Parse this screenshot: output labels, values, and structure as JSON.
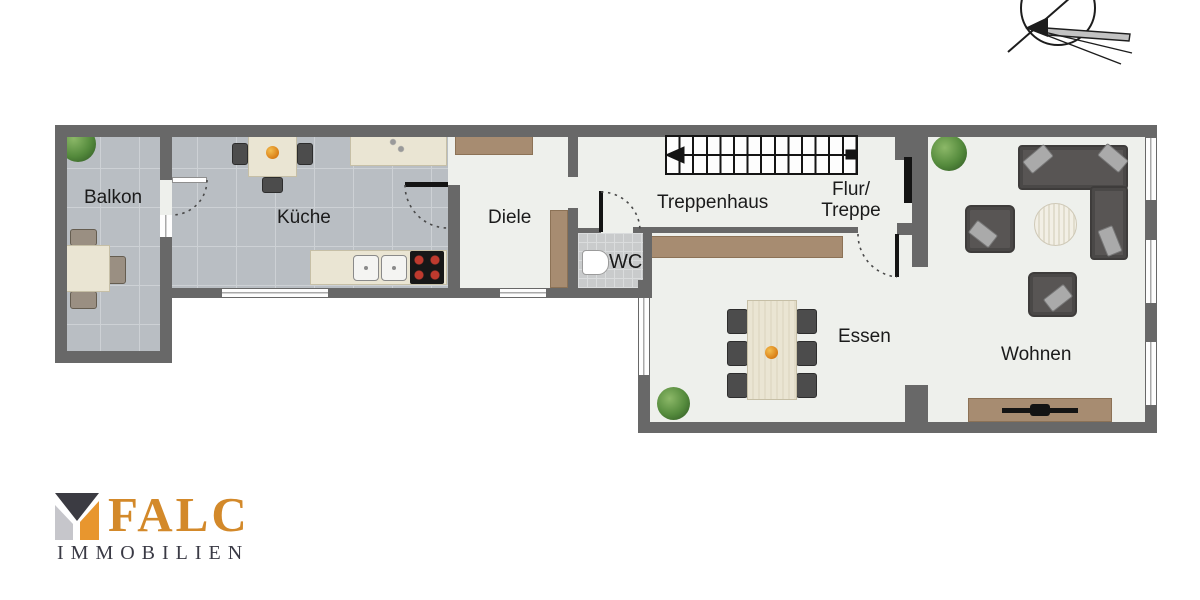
{
  "rooms": {
    "balkon": "Balkon",
    "kueche": "Küche",
    "diele": "Diele",
    "wc": "WC",
    "treppenhaus": "Treppenhaus",
    "flur1": "Flur/",
    "flur2": "Treppe",
    "essen": "Essen",
    "wohnen": "Wohnen"
  },
  "branding": {
    "name": "FALC",
    "subtitle": "IMMOBILIEN",
    "brand_color": "#d3892a",
    "subtitle_color": "#3a3a45",
    "mark_colors": {
      "top": "#3b3b42",
      "left": "#c6c6cb",
      "right": "#e8962e"
    }
  },
  "icons": {
    "compass": "north-arrow-compass",
    "plant": "potted-plant",
    "stairs": "staircase-with-direction-arrow",
    "stove": "four-burner-cooktop",
    "sink": "double-kitchen-sink",
    "toilet": "toilet",
    "tv": "tv-on-sideboard"
  },
  "colors": {
    "wall": "#686868",
    "balcony_tile": "#b9bec3",
    "interior_floor": "#eef0ec",
    "wc_tile": "#c9cbcc",
    "wood_furniture": "#a78c71",
    "cream_furniture": "#eae5d3",
    "dark_furniture": "#4c4c4c"
  }
}
